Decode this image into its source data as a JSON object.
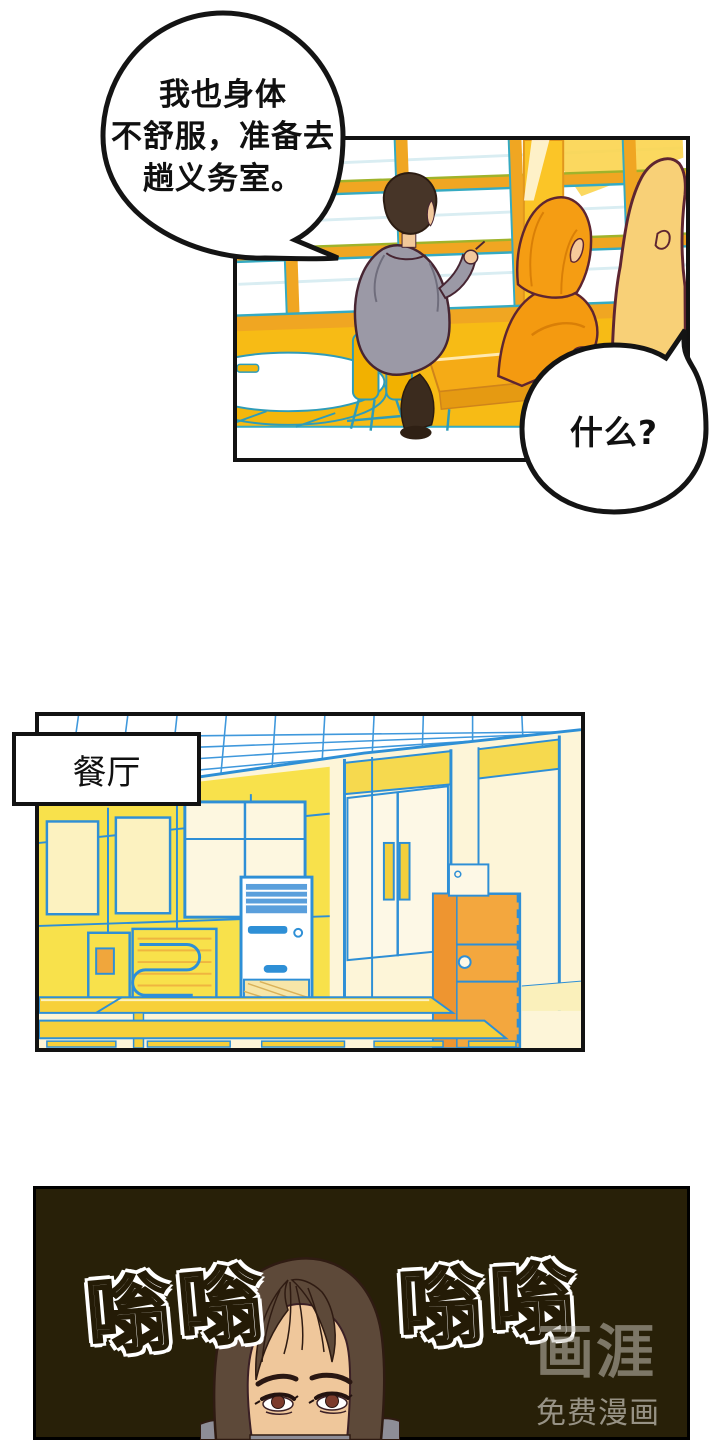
{
  "bubble1": {
    "line1": "我也身体",
    "line2": "不舒服，准备去",
    "line3": "趟义务室。"
  },
  "bubble2": {
    "text": "什么?"
  },
  "location_label": {
    "text": "餐厅"
  },
  "sfx": {
    "first": "嗡嗡",
    "second": "嗡嗡"
  },
  "watermark": {
    "logo": "画涯",
    "tagline": "免费漫画"
  },
  "colors": {
    "panel_border": "#121212",
    "classroom_wall_yellow": "#f7bb15",
    "desk_orange": "#f5ab16",
    "hoodie_gray": "#9b99a6",
    "figure_orange": "#f59d13",
    "silhouette_yellow": "#f8d077",
    "cafeteria_line_blue": "#2e8fd6",
    "cafeteria_wall_yellow": "#f8e14b",
    "vending_orange": "#f3a73e",
    "dark_panel_background": "#282008",
    "sfx_white": "#ffffff",
    "skin_tone": "#efc79b",
    "hair_brown": "#5d4939"
  }
}
